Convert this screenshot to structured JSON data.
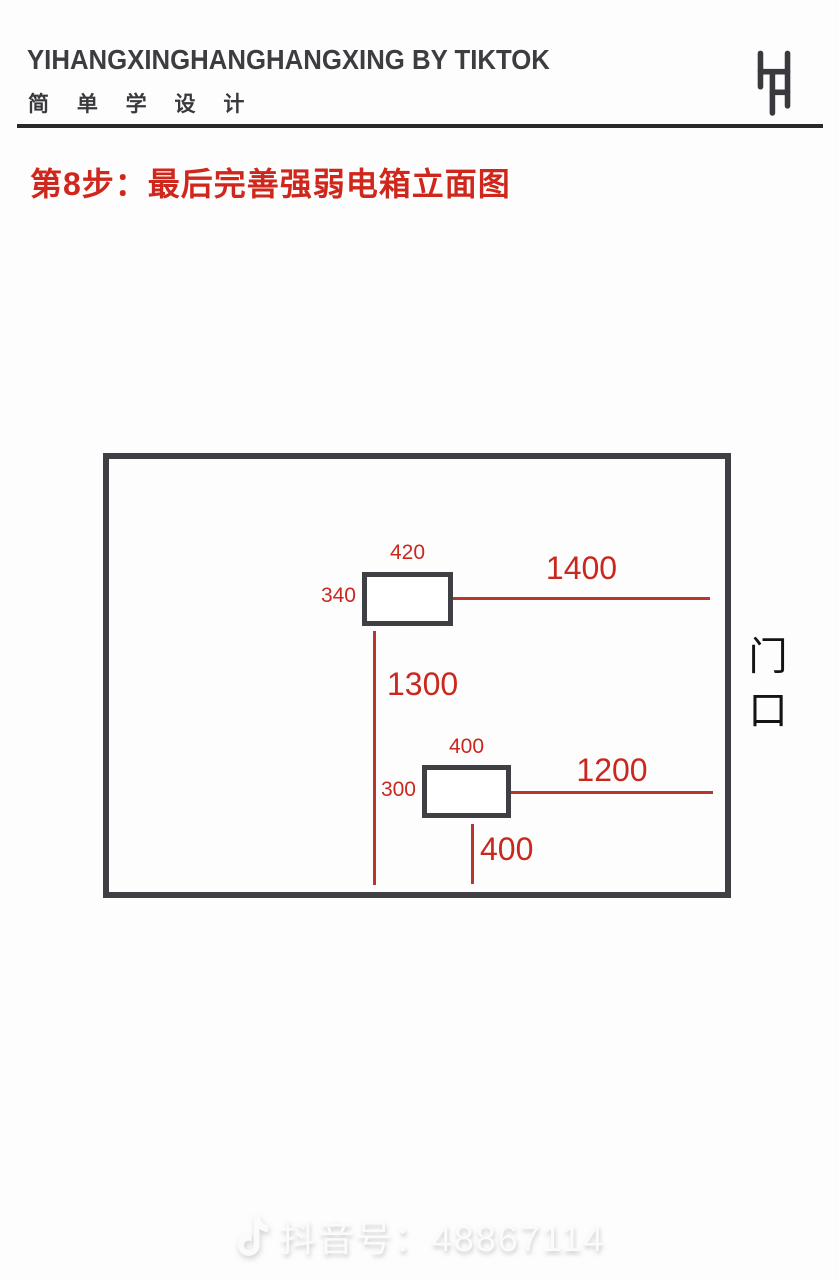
{
  "header": {
    "title": "YIHANGXINGHANGHANGXING BY TIKTOK",
    "subtitle": "简 单 学 设 计",
    "logo_icon": "double-h-monogram"
  },
  "step": {
    "title": "第8步：最后完善强弱电箱立面图"
  },
  "diagram": {
    "wall": "room-wall-elevation",
    "dims": {
      "box1_width": "420",
      "box1_height": "340",
      "box1_to_right_wall": "1400",
      "between_boxes_vertical": "1300",
      "box2_width": "400",
      "box2_height": "300",
      "box2_to_right_wall": "1200",
      "box2_below": "400"
    },
    "door": {
      "label": "门口",
      "top_char": "门",
      "bottom_char": "口"
    }
  },
  "footer": {
    "watermark": "抖音号：48867114",
    "watermark_icon": "tiktok-note"
  },
  "colors": {
    "dimension_red_text": "#c9281e",
    "dimension_red_line": "#b6372c",
    "wall_border": "#404044",
    "ink": "#3d3d41",
    "divider": "#29292b",
    "background": "#fdfdfd"
  }
}
